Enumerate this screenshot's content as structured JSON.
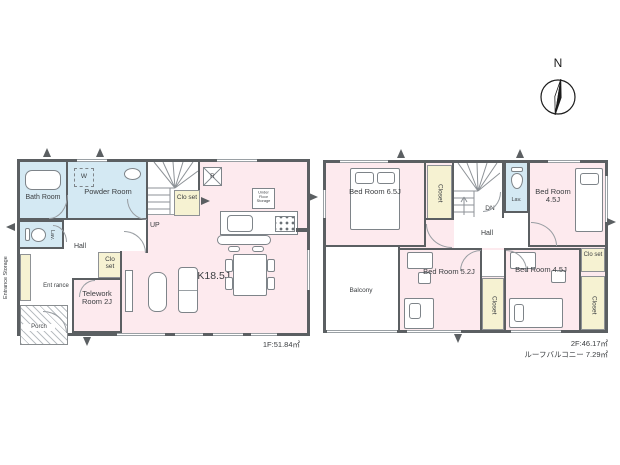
{
  "compass": {
    "north": "N"
  },
  "floor1": {
    "area": "1F:51.84㎡",
    "rooms": {
      "bath": "Bath Room",
      "powder": "Powder Room",
      "washer": "W",
      "lav": "Lav.",
      "hall": "Hall",
      "stair_closet": "Clo set",
      "hall_closet": "Clo set",
      "entrance_storage": "Entrance Storage",
      "entrance": "Ent rance",
      "porch": "Porch",
      "telework": "Telework Room 2J",
      "ldk": "LDK18.5J",
      "up": "UP",
      "fridge": "R",
      "under_floor_storage": "Under Floor Storage"
    }
  },
  "floor2": {
    "area": "2F:46.17㎡",
    "roof_balcony": "ルーフバルコニー 7.29㎡",
    "rooms": {
      "bed_65": "Bed Room 6.5J",
      "bed_45_top": "Bed Room 4.5J",
      "bed_52": "Bed Room 5.2J",
      "bed_45_bottom": "Bed Room 4.5J",
      "closet_top": "Closet",
      "closet_mid": "Closet",
      "closet_right": "Closet",
      "small_closet": "Clo set",
      "lav": "Lav.",
      "hall": "Hall",
      "dn": "DN",
      "balcony": "Balcony"
    }
  },
  "colors": {
    "room_pink": "#fdeaee",
    "wet_area_blue": "#d4e9f3",
    "closet_yellow": "#f6f2d2",
    "wall_gray": "#5b5f62"
  }
}
